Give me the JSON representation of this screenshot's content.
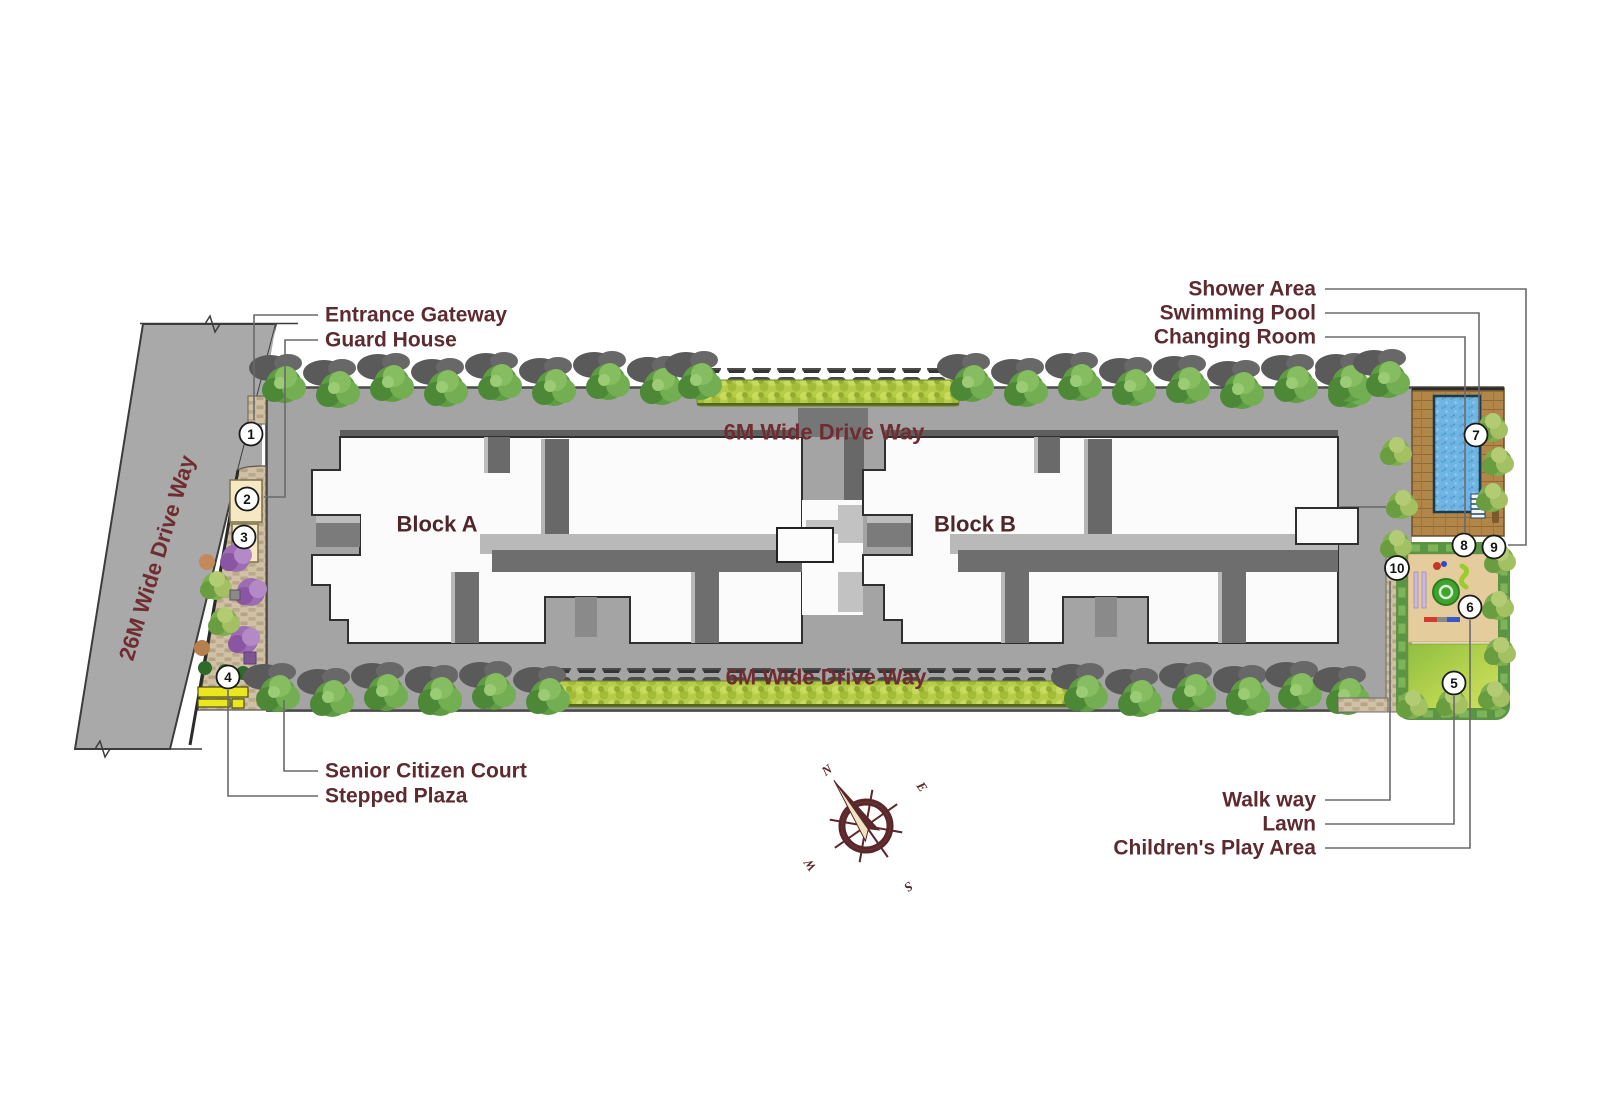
{
  "plan": {
    "road_label": "26M Wide Drive Way",
    "top_driveway_label": "6M Wide Drive Way",
    "bottom_driveway_label": "6M Wide Drive Way",
    "block_a_label": "Block A",
    "block_b_label": "Block B"
  },
  "annotations": {
    "top_left": [
      {
        "label": "Entrance Gateway",
        "marker": "1"
      },
      {
        "label": "Guard House",
        "marker": "2"
      }
    ],
    "bottom_left": [
      {
        "label": "Senior Citizen Court",
        "marker": "3"
      },
      {
        "label": "Stepped Plaza",
        "marker": "4"
      }
    ],
    "top_right": [
      {
        "label": "Shower Area",
        "marker": "9"
      },
      {
        "label": "Swimming Pool",
        "marker": "7"
      },
      {
        "label": "Changing Room",
        "marker": "8"
      }
    ],
    "bottom_right": [
      {
        "label": "Walk way",
        "marker": "10"
      },
      {
        "label": "Lawn",
        "marker": "5"
      },
      {
        "label": "Children's Play Area",
        "marker": "6"
      }
    ]
  },
  "markers": [
    {
      "number": "1",
      "name": "Entrance Gateway"
    },
    {
      "number": "2",
      "name": "Guard House"
    },
    {
      "number": "3",
      "name": "Senior Citizen Court"
    },
    {
      "number": "4",
      "name": "Stepped Plaza"
    },
    {
      "number": "5",
      "name": "Lawn"
    },
    {
      "number": "6",
      "name": "Children's Play Area"
    },
    {
      "number": "7",
      "name": "Swimming Pool"
    },
    {
      "number": "8",
      "name": "Changing Room"
    },
    {
      "number": "9",
      "name": "Shower Area"
    },
    {
      "number": "10",
      "name": "Walk way"
    }
  ],
  "compass": {
    "north": "N",
    "east": "E",
    "south": "S",
    "west": "W"
  },
  "colors": {
    "label-text": "#5d2a30",
    "road-text": "#6f2d31",
    "road-gray": "#a9a9a9",
    "pavement-gray": "#a4a4a4",
    "building-white": "#fbfbfb",
    "tree-green": "#5f9c43",
    "hedge-green": "#b7cc48",
    "pool-blue": "#6fb5e3",
    "deck-wood": "#b28549",
    "lawn-green": "#a9cc4b",
    "sand-tan": "#e4cc9c",
    "bench-yellow": "#ebe71f",
    "plaza-purple": "#9d6cb4",
    "compass-maroon": "#5a272b",
    "leader-line": "#6a6a6a"
  }
}
